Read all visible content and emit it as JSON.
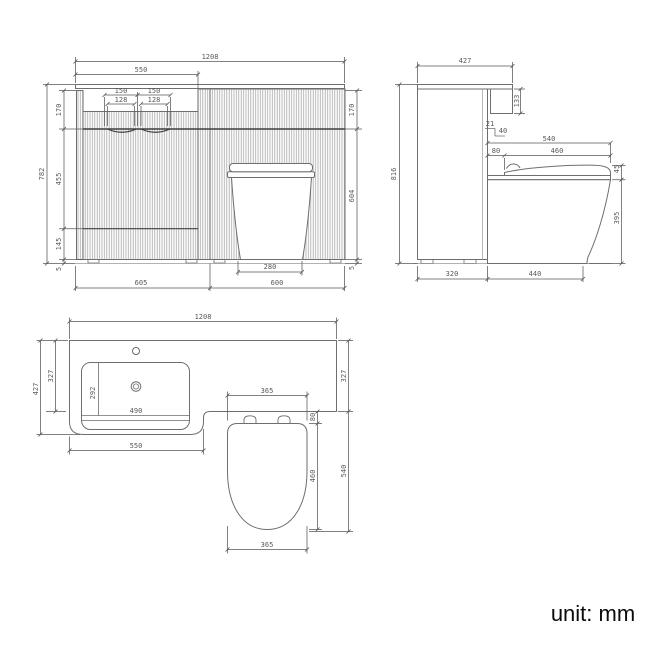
{
  "unit_note": "unit: mm",
  "front_view": {
    "overall_width": "1208",
    "basin_section_width": "550",
    "handle_span_left": "150",
    "handle_span_right": "150",
    "handle_cutout_left": "128",
    "handle_cutout_right": "128",
    "overall_height": "782",
    "left_top_height": "170",
    "left_middle_height": "455",
    "left_bottom_height": "145",
    "left_plinth_gap": "5",
    "right_top_height": "170",
    "right_lower_height": "604",
    "right_plinth_gap": "5",
    "bottom_left_width": "605",
    "bottom_right_width": "600",
    "toilet_base_width": "280"
  },
  "side_view": {
    "overall_depth": "427",
    "fascia_height": "133",
    "overall_height": "816",
    "step_depth": "21",
    "step_drop": "40",
    "toilet_depth": "540",
    "seat_setback": "80",
    "seat_length": "460",
    "seat_thickness": "45",
    "pan_height": "395",
    "cabinet_depth": "320",
    "toilet_projection": "440"
  },
  "top_view": {
    "overall_width": "1208",
    "overall_depth": "427",
    "counter_depth_left": "327",
    "counter_depth_right": "327",
    "basin_inner_depth": "292",
    "basin_inner_width": "490",
    "basin_section_width": "550",
    "seat_width": "365",
    "seat_width_bottom": "365",
    "hinge_setback": "80",
    "seat_length": "460",
    "toilet_overall_length": "540"
  }
}
